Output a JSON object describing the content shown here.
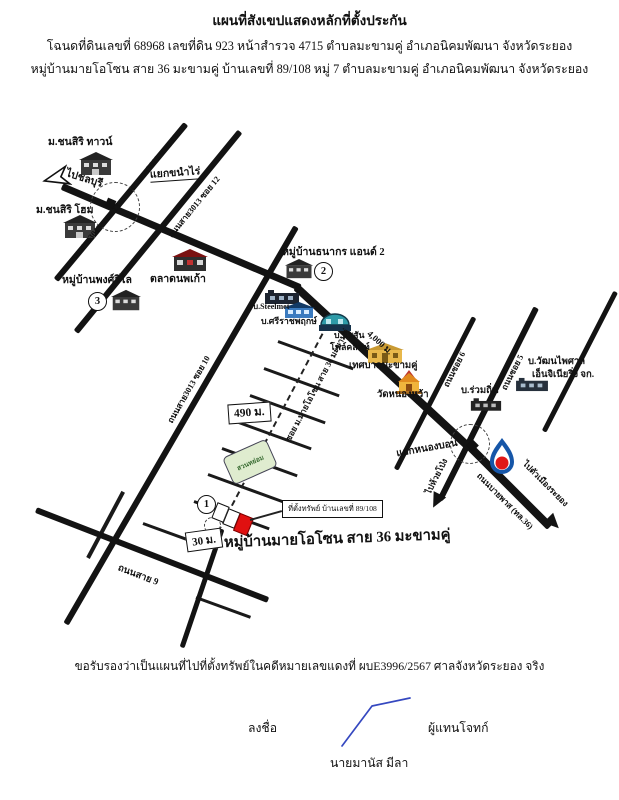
{
  "header": {
    "title": "แผนที่สังเขปแสดงหลักที่ตั้งประกัน",
    "line2": "โฉนดที่ดินเลขที่ 68968  เลขที่ดิน 923 หน้าสำรวจ 4715 ตำบลมะขามคู่  อำเภอนิคมพัฒนา  จังหวัดระยอง",
    "line3": "หมู่บ้านมายโอโซน สาย 36 มะขามคู่ บ้านเลขที่ 89/108 หมู่ 7  ตำบลมะขามคู่  อำเภอนิคมพัฒนา  จังหวัดระยอง"
  },
  "map": {
    "chonsiri_town": "ม.ชนสิริ ทาวน์",
    "to_chonburi": "ไปชลบุรี",
    "yaek_khanam_rai": "แยกขนำไร่",
    "road_soi13": "ถนนสาย3013 ซอย 13",
    "chonsiri_home": "ม.ชนสิริ โฮม",
    "road_soi12": "ถนนสาย3013 ซอย 12",
    "talad_noppakao": "ตลาดนพเก้า",
    "phongwilai": "หมู่บ้านพงศ์วิไล",
    "phongwilai_no": "3",
    "thanakorn": "หมู่บ้านธนากร แอนด์ 2",
    "thanakorn_no": "2",
    "steelmet": "บ.Steelmet",
    "sriracha": "บ.ศรีราชพฤกษ์",
    "nissan1": "บ.นิสสัน",
    "nissan2": "โฟล์คลิฟท์",
    "dist_4000": "4,000 ม.",
    "road_soi10": "ถนนสาย3013 ซอย 10",
    "tessaban": "เทศบาลมะขามคู่",
    "wat": "วัดหนองหว้า",
    "ruamthin": "บ.ร่วมถิ่น",
    "wattana1": "บ.วัฒนไพศาล",
    "wattana2": "เอ็นจิเนียริ่ง จก.",
    "road_soi6": "ถนนซอย 6",
    "road_soi5": "ถนนซอย 5",
    "yaek_nongbon": "แยกหนองบอน",
    "to_huaypong": "ไปห้วยโป่ง",
    "bypass": "ถนนบายพาส (ทล.36)",
    "to_rayong": "ไปตัวเมืองระยอง",
    "ozone_soi": "ซอย ม.มายโอโซน สาย 36 มะขามคู่",
    "park": "สวนหย่อม",
    "dist_490": "490 ม.",
    "dist_30": "30 ม.",
    "spot_no": "1",
    "property": "ที่ตั้งทรัพย์ บ้านเลขที่ 89/108",
    "ozone_title": "หมู่บ้านมายโอโซน สาย 36 มะขามคู่",
    "road_sai9": "ถนนสาย 9"
  },
  "footer": {
    "certify": "ขอรับรองว่าเป็นแผนที่ไปที่ตั้งทรัพย์ในคดีหมายเลขแดงที่ ผบE3996/2567 ศาลจังหวัดระยอง จริง",
    "sign": "ลงชื่อ",
    "role": "ผู้แทนโจทก์",
    "name": "นายมานัส  มีลา"
  },
  "colors": {
    "road": "#131313",
    "ptt_blue": "#1656a8",
    "ptt_red": "#e01818",
    "marker_red": "#e01010",
    "park_green": "#dfeccf",
    "signature_blue": "#3548c0"
  }
}
